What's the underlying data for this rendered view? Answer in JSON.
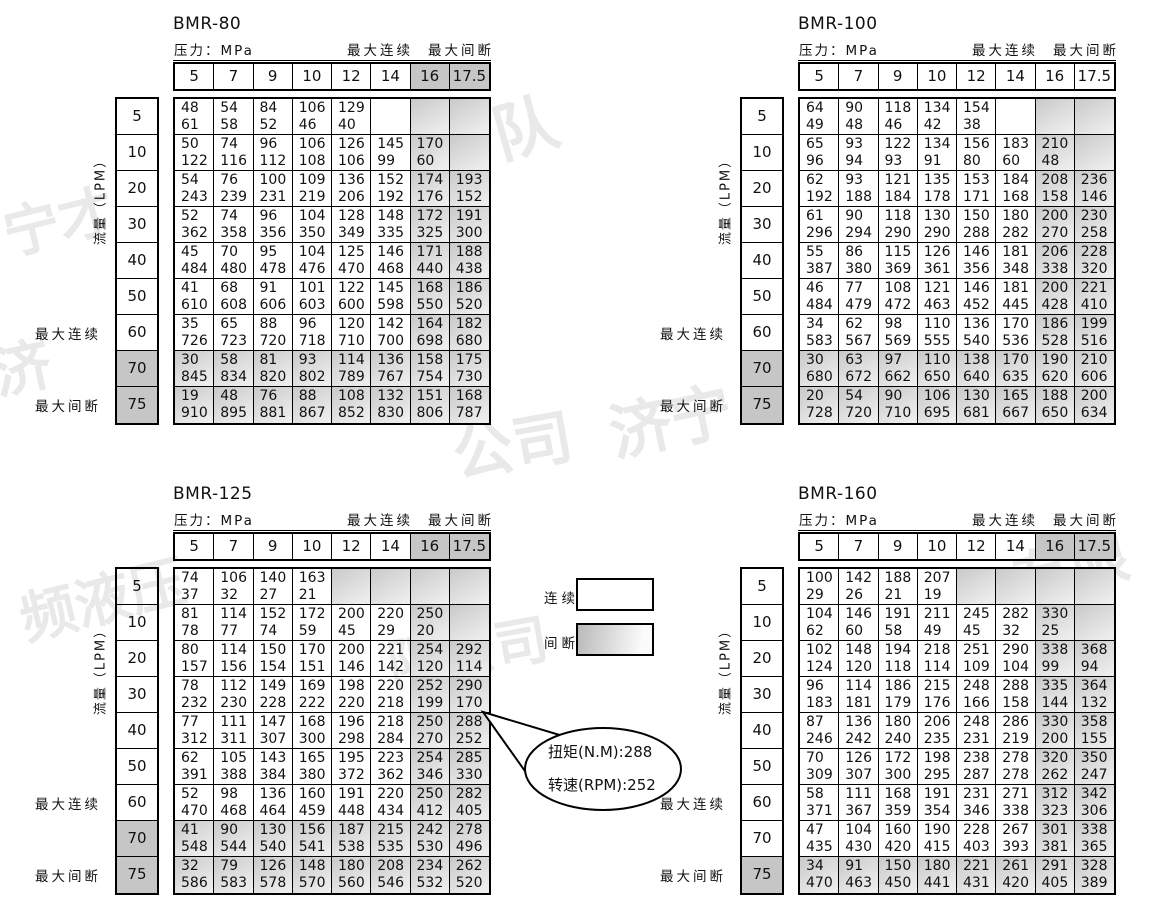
{
  "labels": {
    "pressure": "压力：MPa",
    "max_cont": "最大连续",
    "max_int": "最大间断",
    "flow": "流量（LPM）",
    "legend_cont": "连续",
    "legend_int": "间断"
  },
  "callout": {
    "line1": "扭矩(N.M):288",
    "line2": "转速(RPM):252"
  },
  "watermarks": [
    "队",
    "宁才",
    "济",
    "公司",
    "济宁",
    "频液压",
    "限公司",
    "有限"
  ],
  "colors": {
    "solid_gray": "#c6c6c6",
    "shaded_cell_from": "#c9c9c9",
    "shaded_cell_to": "#ededed",
    "border": "#000000"
  },
  "tables": [
    {
      "title": "BMR-80",
      "gray_header": true,
      "pressures": [
        "5",
        "7",
        "9",
        "10",
        "12",
        "14",
        "16",
        "17.5"
      ],
      "flows": [
        "5",
        "10",
        "20",
        "30",
        "40",
        "50",
        "60",
        "70",
        "75"
      ],
      "gray_rows": [
        "70",
        "75"
      ],
      "rows": [
        [
          [
            "48",
            "61"
          ],
          [
            "54",
            "58"
          ],
          [
            "84",
            "52"
          ],
          [
            "106",
            "46"
          ],
          [
            "129",
            "40"
          ],
          "",
          "",
          ""
        ],
        [
          [
            "50",
            "122"
          ],
          [
            "74",
            "116"
          ],
          [
            "96",
            "112"
          ],
          [
            "106",
            "108"
          ],
          [
            "126",
            "106"
          ],
          [
            "145",
            "99"
          ],
          [
            "170",
            "60"
          ],
          ""
        ],
        [
          [
            "54",
            "243"
          ],
          [
            "76",
            "239"
          ],
          [
            "100",
            "231"
          ],
          [
            "109",
            "219"
          ],
          [
            "136",
            "206"
          ],
          [
            "152",
            "192"
          ],
          [
            "174",
            "176"
          ],
          [
            "193",
            "152"
          ]
        ],
        [
          [
            "52",
            "362"
          ],
          [
            "74",
            "358"
          ],
          [
            "96",
            "356"
          ],
          [
            "104",
            "350"
          ],
          [
            "128",
            "349"
          ],
          [
            "148",
            "335"
          ],
          [
            "172",
            "325"
          ],
          [
            "191",
            "300"
          ]
        ],
        [
          [
            "45",
            "484"
          ],
          [
            "70",
            "480"
          ],
          [
            "95",
            "478"
          ],
          [
            "104",
            "476"
          ],
          [
            "125",
            "470"
          ],
          [
            "146",
            "468"
          ],
          [
            "171",
            "440"
          ],
          [
            "188",
            "438"
          ]
        ],
        [
          [
            "41",
            "610"
          ],
          [
            "68",
            "608"
          ],
          [
            "91",
            "606"
          ],
          [
            "101",
            "603"
          ],
          [
            "122",
            "600"
          ],
          [
            "145",
            "598"
          ],
          [
            "168",
            "550"
          ],
          [
            "186",
            "520"
          ]
        ],
        [
          [
            "35",
            "726"
          ],
          [
            "65",
            "723"
          ],
          [
            "88",
            "720"
          ],
          [
            "96",
            "718"
          ],
          [
            "120",
            "710"
          ],
          [
            "142",
            "700"
          ],
          [
            "164",
            "698"
          ],
          [
            "182",
            "680"
          ]
        ],
        [
          [
            "30",
            "845"
          ],
          [
            "58",
            "834"
          ],
          [
            "81",
            "820"
          ],
          [
            "93",
            "802"
          ],
          [
            "114",
            "789"
          ],
          [
            "136",
            "767"
          ],
          [
            "158",
            "754"
          ],
          [
            "175",
            "730"
          ]
        ],
        [
          [
            "19",
            "910"
          ],
          [
            "48",
            "895"
          ],
          [
            "76",
            "881"
          ],
          [
            "88",
            "867"
          ],
          [
            "108",
            "852"
          ],
          [
            "132",
            "830"
          ],
          [
            "151",
            "806"
          ],
          [
            "168",
            "787"
          ]
        ]
      ]
    },
    {
      "title": "BMR-100",
      "gray_header": false,
      "pressures": [
        "5",
        "7",
        "9",
        "10",
        "12",
        "14",
        "16",
        "17.5"
      ],
      "flows": [
        "5",
        "10",
        "20",
        "30",
        "40",
        "50",
        "60",
        "70",
        "75"
      ],
      "gray_rows": [
        "70",
        "75"
      ],
      "rows": [
        [
          [
            "64",
            "49"
          ],
          [
            "90",
            "48"
          ],
          [
            "118",
            "46"
          ],
          [
            "134",
            "42"
          ],
          [
            "154",
            "38"
          ],
          "",
          "",
          ""
        ],
        [
          [
            "65",
            "96"
          ],
          [
            "93",
            "94"
          ],
          [
            "122",
            "93"
          ],
          [
            "134",
            "91"
          ],
          [
            "156",
            "80"
          ],
          [
            "183",
            "60"
          ],
          [
            "210",
            "48"
          ],
          ""
        ],
        [
          [
            "62",
            "192"
          ],
          [
            "93",
            "188"
          ],
          [
            "121",
            "184"
          ],
          [
            "135",
            "178"
          ],
          [
            "153",
            "171"
          ],
          [
            "184",
            "168"
          ],
          [
            "208",
            "158"
          ],
          [
            "236",
            "146"
          ]
        ],
        [
          [
            "61",
            "296"
          ],
          [
            "90",
            "294"
          ],
          [
            "118",
            "290"
          ],
          [
            "130",
            "290"
          ],
          [
            "150",
            "288"
          ],
          [
            "180",
            "282"
          ],
          [
            "200",
            "270"
          ],
          [
            "230",
            "258"
          ]
        ],
        [
          [
            "55",
            "387"
          ],
          [
            "86",
            "380"
          ],
          [
            "115",
            "369"
          ],
          [
            "126",
            "361"
          ],
          [
            "146",
            "356"
          ],
          [
            "181",
            "348"
          ],
          [
            "206",
            "338"
          ],
          [
            "228",
            "320"
          ]
        ],
        [
          [
            "46",
            "484"
          ],
          [
            "77",
            "479"
          ],
          [
            "108",
            "472"
          ],
          [
            "121",
            "463"
          ],
          [
            "146",
            "452"
          ],
          [
            "181",
            "445"
          ],
          [
            "200",
            "428"
          ],
          [
            "221",
            "410"
          ]
        ],
        [
          [
            "34",
            "583"
          ],
          [
            "62",
            "567"
          ],
          [
            "98",
            "569"
          ],
          [
            "110",
            "555"
          ],
          [
            "136",
            "540"
          ],
          [
            "170",
            "536"
          ],
          [
            "186",
            "528"
          ],
          [
            "199",
            "516"
          ]
        ],
        [
          [
            "30",
            "680"
          ],
          [
            "63",
            "672"
          ],
          [
            "97",
            "662"
          ],
          [
            "110",
            "650"
          ],
          [
            "138",
            "640"
          ],
          [
            "170",
            "635"
          ],
          [
            "190",
            "620"
          ],
          [
            "210",
            "606"
          ]
        ],
        [
          [
            "20",
            "728"
          ],
          [
            "54",
            "720"
          ],
          [
            "90",
            "710"
          ],
          [
            "106",
            "695"
          ],
          [
            "130",
            "681"
          ],
          [
            "165",
            "667"
          ],
          [
            "188",
            "650"
          ],
          [
            "200",
            "634"
          ]
        ]
      ]
    },
    {
      "title": "BMR-125",
      "gray_header": true,
      "pressures": [
        "5",
        "7",
        "9",
        "10",
        "12",
        "14",
        "16",
        "17.5"
      ],
      "flows": [
        "5",
        "10",
        "20",
        "30",
        "40",
        "50",
        "60",
        "70",
        "75"
      ],
      "gray_rows": [
        "70",
        "75"
      ],
      "rows": [
        [
          [
            "74",
            "37"
          ],
          [
            "106",
            "32"
          ],
          [
            "140",
            "27"
          ],
          [
            "163",
            "21"
          ],
          "g",
          "g",
          "",
          ""
        ],
        [
          [
            "81",
            "78"
          ],
          [
            "114",
            "77"
          ],
          [
            "152",
            "74"
          ],
          [
            "172",
            "59"
          ],
          [
            "200",
            "45"
          ],
          [
            "220",
            "29"
          ],
          [
            "250",
            "20"
          ],
          ""
        ],
        [
          [
            "80",
            "157"
          ],
          [
            "114",
            "156"
          ],
          [
            "150",
            "154"
          ],
          [
            "170",
            "151"
          ],
          [
            "200",
            "146"
          ],
          [
            "221",
            "142"
          ],
          [
            "254",
            "120"
          ],
          [
            "292",
            "114"
          ]
        ],
        [
          [
            "78",
            "232"
          ],
          [
            "112",
            "230"
          ],
          [
            "149",
            "228"
          ],
          [
            "169",
            "222"
          ],
          [
            "198",
            "220"
          ],
          [
            "220",
            "218"
          ],
          [
            "252",
            "199"
          ],
          [
            "290",
            "170"
          ]
        ],
        [
          [
            "77",
            "312"
          ],
          [
            "111",
            "311"
          ],
          [
            "147",
            "307"
          ],
          [
            "168",
            "300"
          ],
          [
            "196",
            "298"
          ],
          [
            "218",
            "284"
          ],
          [
            "250",
            "270"
          ],
          [
            "288",
            "252"
          ]
        ],
        [
          [
            "62",
            "391"
          ],
          [
            "105",
            "388"
          ],
          [
            "143",
            "384"
          ],
          [
            "165",
            "380"
          ],
          [
            "195",
            "372"
          ],
          [
            "223",
            "362"
          ],
          [
            "254",
            "346"
          ],
          [
            "285",
            "330"
          ]
        ],
        [
          [
            "52",
            "470"
          ],
          [
            "98",
            "468"
          ],
          [
            "136",
            "464"
          ],
          [
            "160",
            "459"
          ],
          [
            "191",
            "448"
          ],
          [
            "220",
            "434"
          ],
          [
            "250",
            "412"
          ],
          [
            "282",
            "405"
          ]
        ],
        [
          [
            "41",
            "548"
          ],
          [
            "90",
            "544"
          ],
          [
            "130",
            "540"
          ],
          [
            "156",
            "541"
          ],
          [
            "187",
            "538"
          ],
          [
            "215",
            "535"
          ],
          [
            "242",
            "530"
          ],
          [
            "278",
            "496"
          ]
        ],
        [
          [
            "32",
            "586"
          ],
          [
            "79",
            "583"
          ],
          [
            "126",
            "578"
          ],
          [
            "148",
            "570"
          ],
          [
            "180",
            "560"
          ],
          [
            "208",
            "546"
          ],
          [
            "234",
            "532"
          ],
          [
            "262",
            "520"
          ]
        ]
      ]
    },
    {
      "title": "BMR-160",
      "gray_header": true,
      "pressures": [
        "5",
        "7",
        "9",
        "10",
        "12",
        "14",
        "16",
        "17.5"
      ],
      "flows": [
        "5",
        "10",
        "20",
        "30",
        "40",
        "50",
        "60",
        "70",
        "75"
      ],
      "gray_rows": [
        "75"
      ],
      "rows": [
        [
          [
            "100",
            "29"
          ],
          [
            "142",
            "26"
          ],
          [
            "188",
            "21"
          ],
          [
            "207",
            "19"
          ],
          "g",
          "g",
          "",
          ""
        ],
        [
          [
            "104",
            "62"
          ],
          [
            "146",
            "60"
          ],
          [
            "191",
            "58"
          ],
          [
            "211",
            "49"
          ],
          [
            "245",
            "45"
          ],
          [
            "282",
            "32"
          ],
          [
            "330",
            "25"
          ],
          ""
        ],
        [
          [
            "102",
            "124"
          ],
          [
            "148",
            "120"
          ],
          [
            "194",
            "118"
          ],
          [
            "218",
            "114"
          ],
          [
            "251",
            "109"
          ],
          [
            "290",
            "104"
          ],
          [
            "338",
            "99"
          ],
          [
            "368",
            "94"
          ]
        ],
        [
          [
            "96",
            "183"
          ],
          [
            "114",
            "181"
          ],
          [
            "186",
            "179"
          ],
          [
            "215",
            "176"
          ],
          [
            "248",
            "166"
          ],
          [
            "288",
            "158"
          ],
          [
            "335",
            "144"
          ],
          [
            "364",
            "132"
          ]
        ],
        [
          [
            "87",
            "246"
          ],
          [
            "136",
            "242"
          ],
          [
            "180",
            "240"
          ],
          [
            "206",
            "235"
          ],
          [
            "248",
            "231"
          ],
          [
            "286",
            "219"
          ],
          [
            "330",
            "200"
          ],
          [
            "358",
            "155"
          ]
        ],
        [
          [
            "70",
            "309"
          ],
          [
            "126",
            "307"
          ],
          [
            "172",
            "300"
          ],
          [
            "198",
            "295"
          ],
          [
            "238",
            "287"
          ],
          [
            "278",
            "278"
          ],
          [
            "320",
            "262"
          ],
          [
            "350",
            "247"
          ]
        ],
        [
          [
            "58",
            "371"
          ],
          [
            "111",
            "367"
          ],
          [
            "168",
            "359"
          ],
          [
            "191",
            "354"
          ],
          [
            "231",
            "346"
          ],
          [
            "271",
            "338"
          ],
          [
            "312",
            "323"
          ],
          [
            "342",
            "306"
          ]
        ],
        [
          [
            "47",
            "435"
          ],
          [
            "104",
            "430"
          ],
          [
            "160",
            "420"
          ],
          [
            "190",
            "415"
          ],
          [
            "228",
            "403"
          ],
          [
            "267",
            "393"
          ],
          [
            "301",
            "381"
          ],
          [
            "338",
            "365"
          ]
        ],
        [
          [
            "34",
            "470"
          ],
          [
            "91",
            "463"
          ],
          [
            "150",
            "450"
          ],
          [
            "180",
            "441"
          ],
          [
            "221",
            "431"
          ],
          [
            "261",
            "420"
          ],
          [
            "291",
            "405"
          ],
          [
            "328",
            "389"
          ]
        ]
      ]
    }
  ]
}
